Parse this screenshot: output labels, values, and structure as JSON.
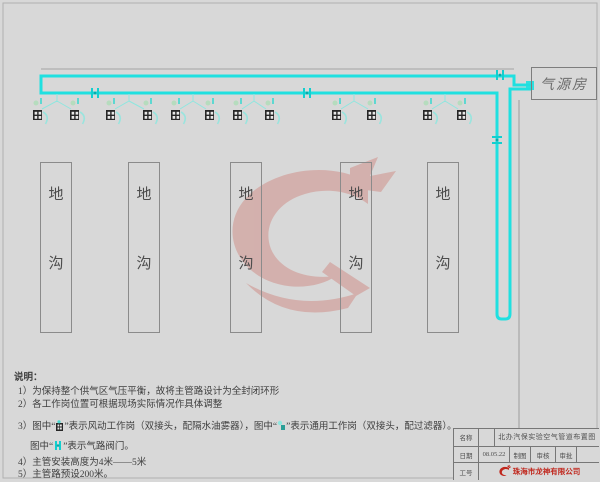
{
  "colors": {
    "background": "#d8d8d8",
    "pipe_cyan": "#1fe0e0",
    "pale_cyan": "#8fe6df",
    "pale_green": "#b2ddbb",
    "icon_dark": "#262626",
    "watermark_red": "#c9493c",
    "company_red": "#c0271d",
    "line_gray": "#9c9c9c"
  },
  "air_room": {
    "label": "气源房"
  },
  "trench": {
    "char_top": "地",
    "char_bottom": "沟"
  },
  "legend": {
    "pneumatic_station": "风动工作岗",
    "general_station": "通用工作岗",
    "valve": "气路阀门",
    "main_pipe": "主管路"
  },
  "notes": {
    "heading": "说明：",
    "line1": "1）为保持整个供气区气压平衡，故将主管路设计为全封闭环形",
    "line2": "2）各工作岗位置可根据现场实际情况作具体调整",
    "line3_pre": "3）图中“",
    "line3_mid": "”表示风动工作岗（双接头，配隔水油雾器），图中“",
    "line3_post": "”表示通用工作岗（双接头，配过滤器）。",
    "line4_pre": "图中“",
    "line4_post": "”表示气路阀门。",
    "line5": "4）主管安装高度为4米——5米",
    "line6": "5）主管路预设200米。"
  },
  "title_block": {
    "name_label": "名称",
    "drawing_title": "北办汽保实验空气管道布置图",
    "date_label": "日期",
    "date_value": "08.05.22",
    "drawn_label": "制图",
    "checked_label": "审核",
    "approved_label": "审批",
    "job_label": "工号",
    "company": "珠海市龙神有限公司"
  }
}
